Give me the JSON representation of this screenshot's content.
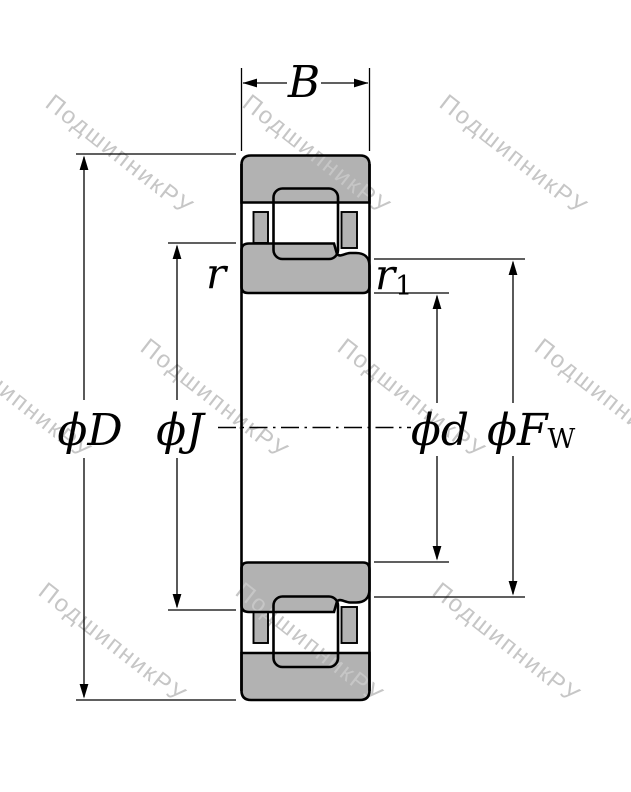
{
  "drawing_title": "cylindrical-roller-bearing-cross-section",
  "labels": {
    "width": "B",
    "outer_diameter": "ϕD",
    "rib_diameter": "ϕJ",
    "bore_diameter": "ϕd",
    "raceway_diameter_main": "ϕF",
    "raceway_diameter_sub": "W",
    "chamfer_r": "r",
    "chamfer_r1_main": "r",
    "chamfer_r1_sub": "1"
  },
  "watermark": {
    "text": "ПодшипникРУ",
    "color": "#c6c6c6"
  },
  "colors": {
    "background": "#ffffff",
    "bearing_fill": "#b2b2b2",
    "line": "#000000"
  }
}
